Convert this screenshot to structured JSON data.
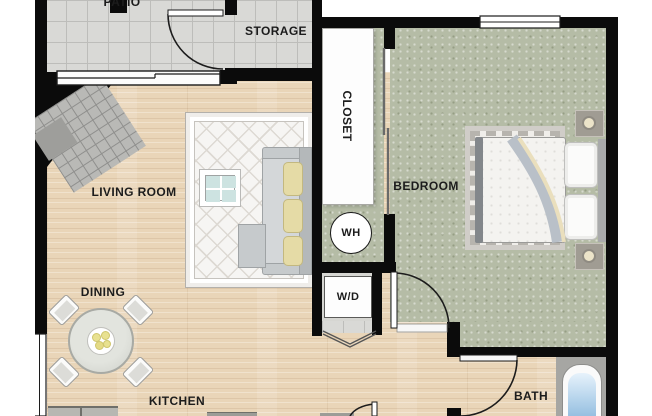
{
  "rooms": {
    "patio": "PATIO",
    "storage": "STORAGE",
    "closet": "CLOSET",
    "bedroom": "BEDROOM",
    "living_room": "LIVING ROOM",
    "dining": "DINING",
    "kitchen": "KITCHEN",
    "bath": "BATH"
  },
  "fixtures": {
    "water_heater": "WH",
    "washer_dryer": "W/D"
  },
  "colors": {
    "wall": "#0b0b0b",
    "wood_floor": "#e9d5b8",
    "tile_floor": "#d9d9d6",
    "bedroom_carpet": "#b5bca6",
    "area_rug": "#f6f5f3",
    "sofa_cushion": "#e5dba6",
    "tub_water": "#8db8dc",
    "counter": "#b7b7b2"
  }
}
